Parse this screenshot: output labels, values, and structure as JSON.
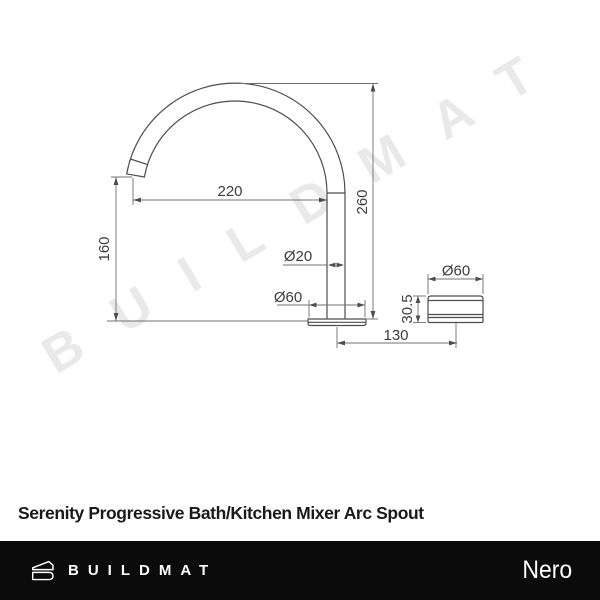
{
  "watermark": {
    "text": "BUILDMAT"
  },
  "drawing": {
    "front_view": {
      "spout_reach": "220",
      "total_height": "260",
      "spout_height": "160",
      "pipe_diameter": "Ø20",
      "base_diameter": "Ø60",
      "base_offset": "130"
    },
    "side_view": {
      "base_diameter": "Ø60",
      "base_height": "30.5"
    }
  },
  "title": "Serenity Progressive Bath/Kitchen Mixer Arc Spout",
  "footer": {
    "brand": "BUILDMAT",
    "sub_brand": "Nero"
  },
  "colors": {
    "drawing_line": "#4d4d4d",
    "dimension_line": "#707070",
    "dimension_text": "#3d3d3d",
    "watermark": "rgba(0,0,0,0.085)",
    "title": "#1a1a1a",
    "footer_background": "#0b0b0b",
    "footer_text": "#ffffff"
  }
}
